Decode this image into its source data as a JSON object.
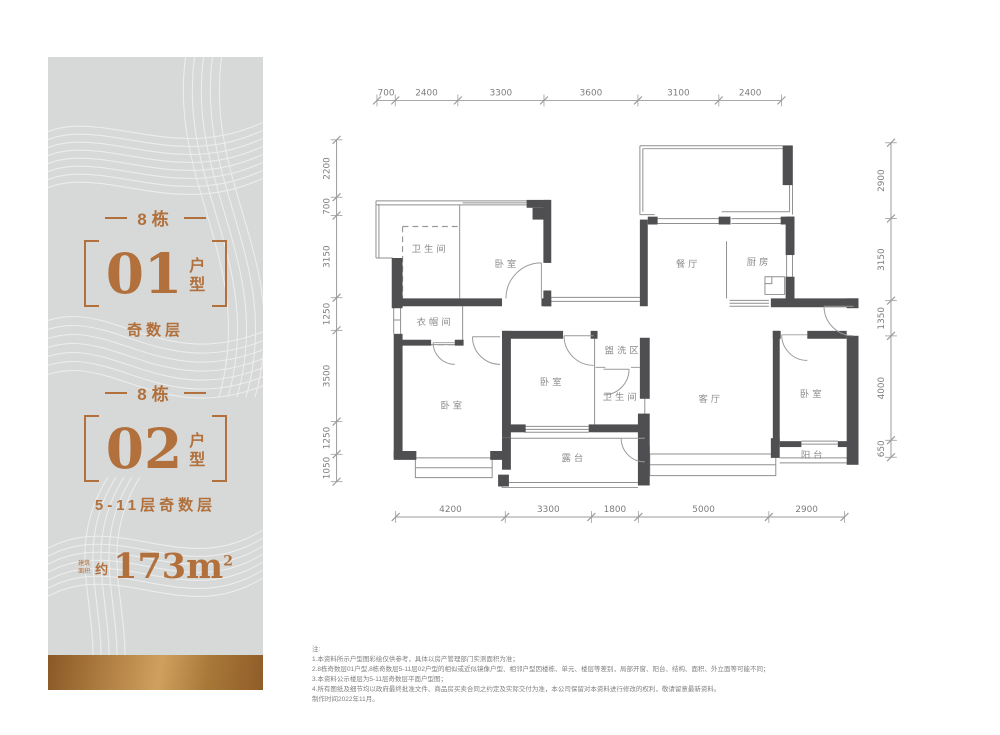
{
  "accent_color": "#b1703c",
  "wall_color": "#4f4f52",
  "panel": {
    "unit1": {
      "building": "8栋",
      "number": "01",
      "suffix_chars": [
        "户",
        "型"
      ],
      "floors": "奇数层"
    },
    "unit2": {
      "building": "8栋",
      "number": "02",
      "suffix_chars": [
        "户",
        "型"
      ],
      "floors": "5-11层奇数层"
    },
    "area": {
      "prefix_line1": "建筑",
      "prefix_line2": "面积",
      "approx": "约",
      "value": "173m",
      "sup": "2"
    }
  },
  "plan": {
    "rooms": {
      "bath1": {
        "label": "卫生间"
      },
      "bed1": {
        "label": "卧室"
      },
      "cloak": {
        "label": "衣帽间"
      },
      "dining": {
        "label": "餐厅"
      },
      "kitchen": {
        "label": "厨房"
      },
      "wash": {
        "label": "盥洗区"
      },
      "bath2": {
        "label": "卫生间"
      },
      "bed2": {
        "label": "卧室"
      },
      "bed3": {
        "label": "卧室"
      },
      "living": {
        "label": "客厅"
      },
      "bed4": {
        "label": "卧室"
      },
      "terrace": {
        "label": "露台"
      },
      "balcony": {
        "label": "阳台"
      }
    },
    "dims": {
      "top": {
        "segments": [
          700,
          2400,
          3300,
          3600,
          3100,
          2400
        ]
      },
      "bottom": {
        "segments": [
          4200,
          3300,
          1800,
          5000,
          2900
        ]
      },
      "left": {
        "segments": [
          2200,
          700,
          3150,
          1250,
          3500,
          1250,
          1050
        ]
      },
      "right": {
        "segments": [
          2900,
          3150,
          1350,
          4000,
          650
        ]
      }
    }
  },
  "notes": {
    "lines": [
      "注:",
      "1.本资料所示户型图彩绘仅供参考，具体以房产管理部门实测面积为准；",
      "2.8栋奇数层01户型,8栋奇数层5-11层02户型的相似或近似镜像户型、相邻户型因楼栋、单元、楼层等差别，局部开窗、阳台、结构、面积、外立面等可能不同；",
      "3.本资料公示楼层为5-11层奇数层平面户型图；",
      "4.所有图纸及细节均以政府最终批准文件、商品房买卖合同之约定及实际交付为准，本公司保留对本资料进行修改的权利，敬请留意最新资料。",
      "制作时间2022年11月。"
    ]
  }
}
